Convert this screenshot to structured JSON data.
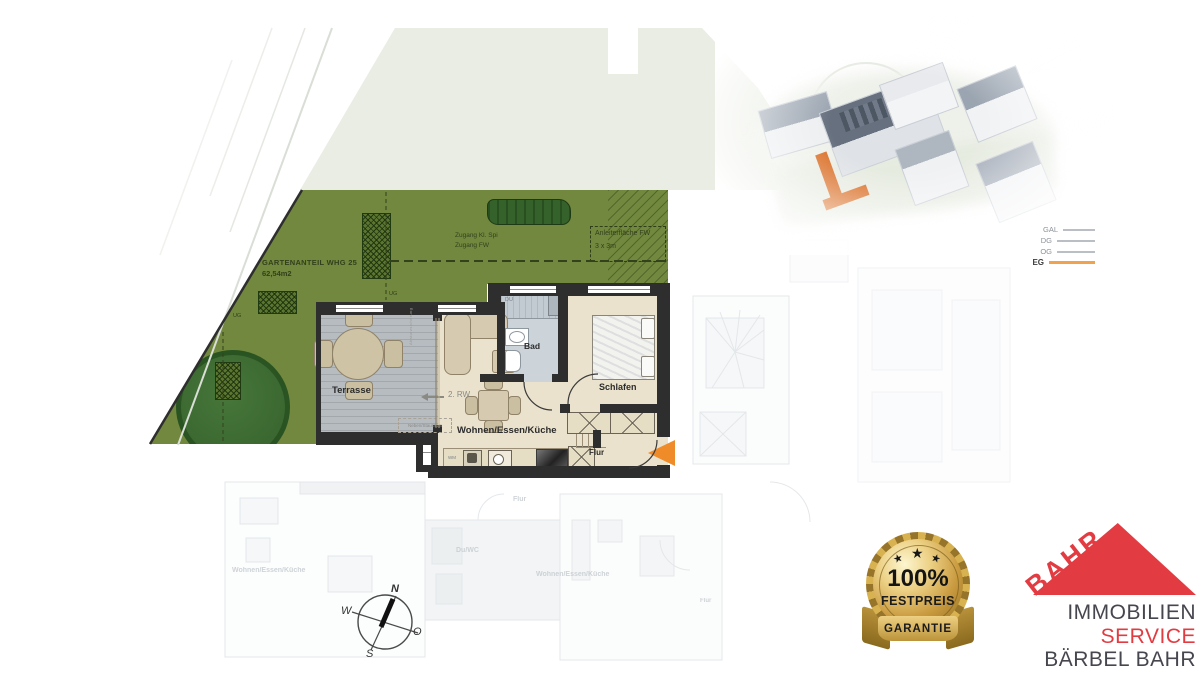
{
  "garden": {
    "parcel_line1": "GARTENANTEIL WHG 25",
    "parcel_line2": "62,54m2",
    "access_line1": "Zugang Kl. Spi",
    "access_line2": "Zugang FW",
    "ladder_line1": "Anleiterfläche FW",
    "ladder_line2": "3 x 3m",
    "ug_top": "UG",
    "ug_left": "UG"
  },
  "apartment": {
    "terrasse": "Terrasse",
    "living": "Wohnen/Essen/Küche",
    "bad": "Bad",
    "schlafen": "Schlafen",
    "flur": "Flur",
    "du": "DU",
    "wm": "WM",
    "escape_route": "2. RW",
    "storage": "Neben/Stauraum",
    "window_note": "Absturzsicherung"
  },
  "ghost_labels": {
    "flur_top": "Flur",
    "du_wc": "Du/WC",
    "living_left": "Wohnen/Essen/Küche",
    "living_right": "Wohnen/Essen/Küche",
    "flur_right": "Flur"
  },
  "compass": {
    "north": "N",
    "south": "S",
    "west": "W",
    "east": "O"
  },
  "levels": [
    {
      "label": "GAL",
      "active": false
    },
    {
      "label": "DG",
      "active": false
    },
    {
      "label": "OG",
      "active": false
    },
    {
      "label": "EG",
      "active": true
    }
  ],
  "badge": {
    "star": "★",
    "value": "100%",
    "line2": "FESTPREIS",
    "line3": "GARANTIE"
  },
  "logo": {
    "brand": "BAHR",
    "line1": "IMMOBILIEN",
    "line2": "SERVICE",
    "line3": "BÄRBEL BAHR"
  },
  "colors": {
    "garden_green": "#71883e",
    "pale_field": "#e9ede3",
    "wall_dark": "#2e2e2e",
    "floor_beige": "#eae2cc",
    "terrace_gray": "#b7bcc1",
    "bath_gray": "#ccd3d9",
    "accent_orange": "#ef8b28",
    "brand_red": "#e23b42",
    "badge_gold": "#c99a3f"
  }
}
